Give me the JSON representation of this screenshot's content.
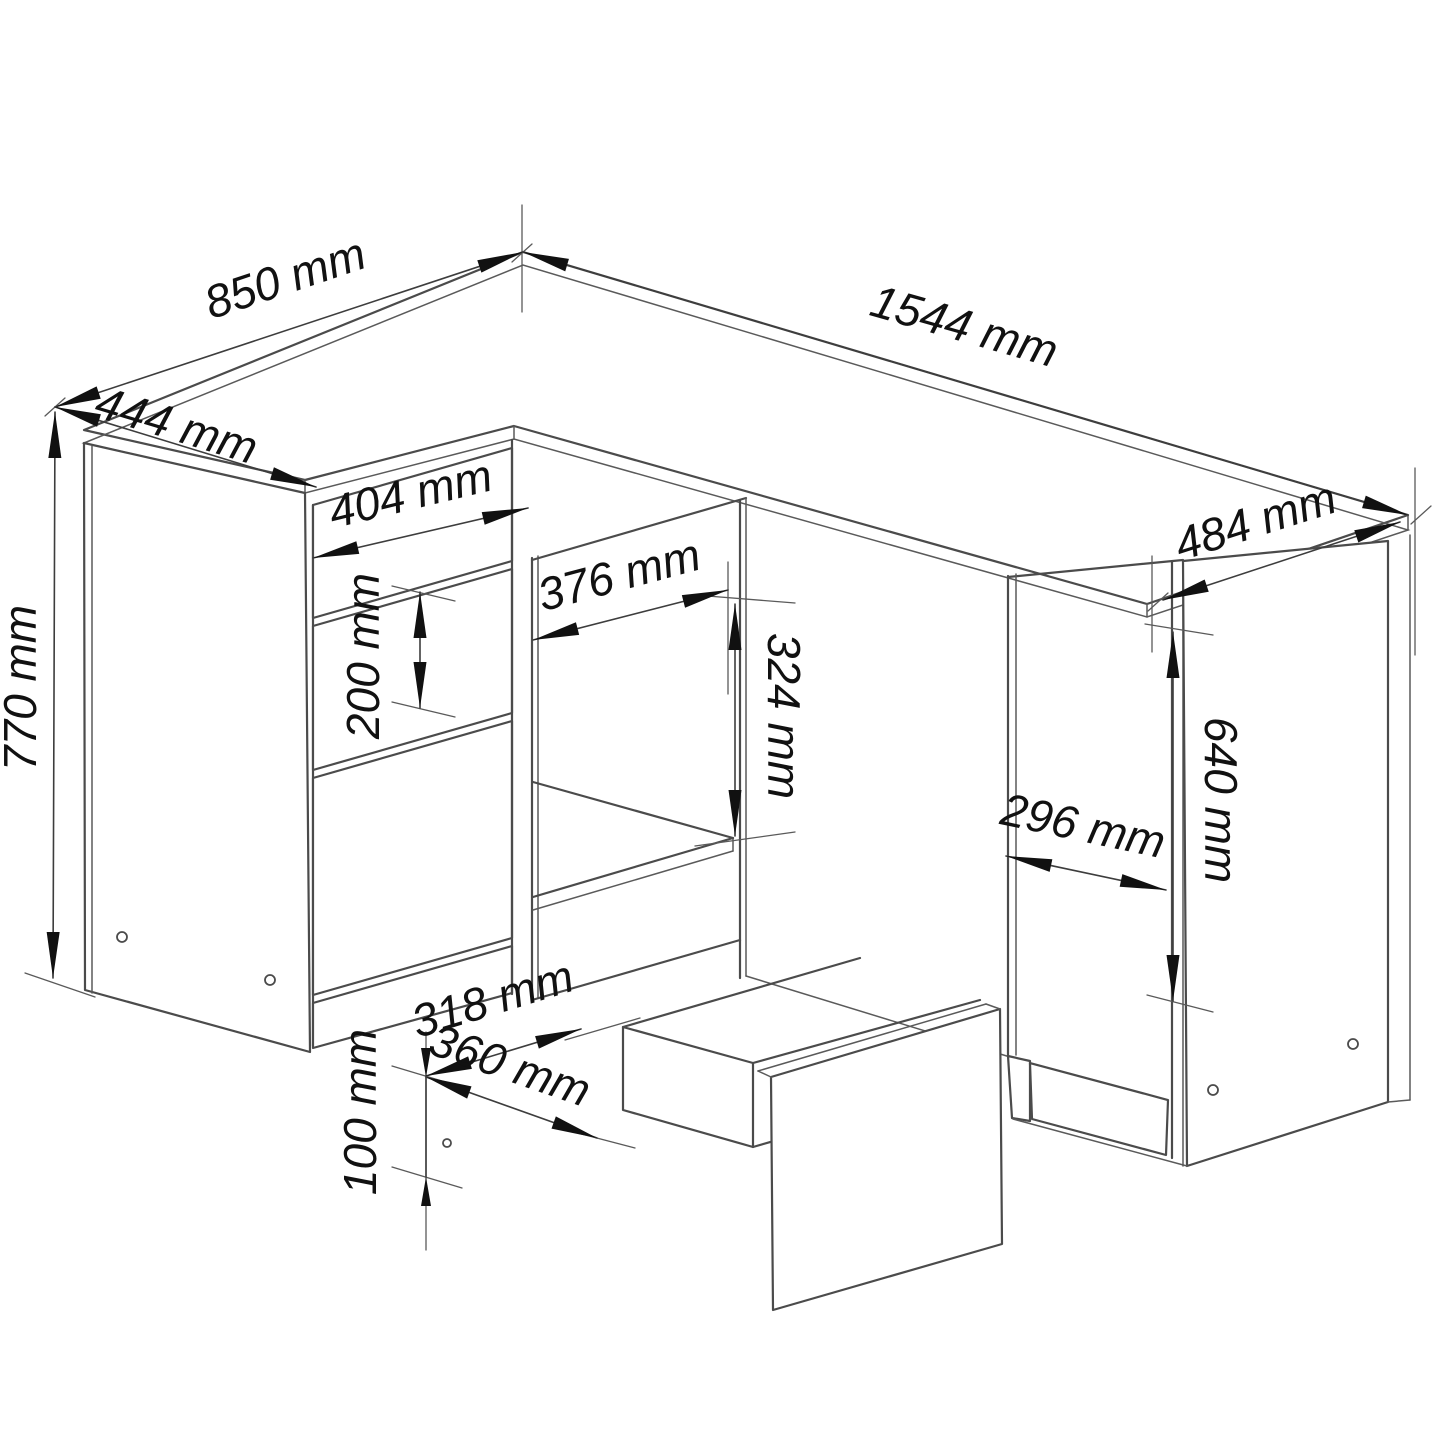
{
  "document": {
    "title": "Corner desk dimension drawing",
    "kind": "technical line drawing",
    "unit": "mm"
  },
  "colors": {
    "background": "#ffffff",
    "line": "#4b4b4b",
    "dimension_line": "#3d3d3d",
    "text": "#111111"
  },
  "dimensions_mm": {
    "desk_top_length": 1544,
    "desk_top_depth": 484,
    "return_top_length": 850,
    "return_top_depth": 444,
    "overall_height": 770,
    "drawer_front_width": 404,
    "middle_drawer_front_height": 200,
    "open_compartment_width": 376,
    "open_compartment_height_above_shelf": 324,
    "cabinet_front_width": 296,
    "cabinet_door_height": 640,
    "drawer_box_inner_width": 318,
    "drawer_box_depth": 360,
    "drawer_box_height": 100
  },
  "labels": {
    "d850": "850 mm",
    "d444": "444 mm",
    "d1544": "1544 mm",
    "d484": "484 mm",
    "d404": "404 mm",
    "d376": "376 mm",
    "d324": "324 mm",
    "d200": "200 mm",
    "d770": "770 mm",
    "d296": "296 mm",
    "d640": "640 mm",
    "d318": "318 mm",
    "d360": "360 mm",
    "d100": "100 mm"
  }
}
